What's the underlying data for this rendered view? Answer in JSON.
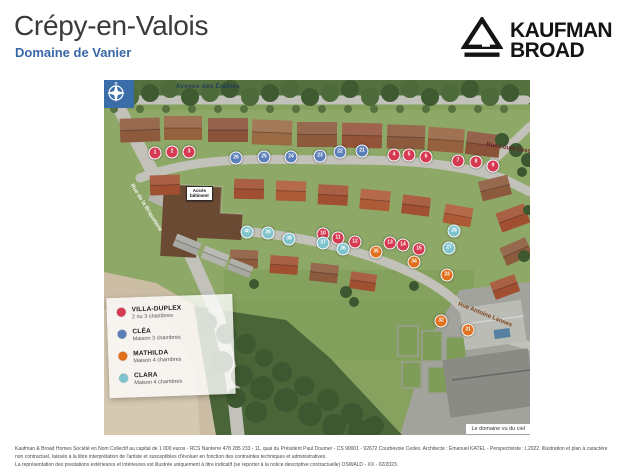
{
  "page": {
    "title": "Crépy-en-Valois",
    "subtitle": "Domaine de Vanier"
  },
  "brand": {
    "line1": "KAUFMAN",
    "line2": "BROAD"
  },
  "map": {
    "caption": "Le domaine vu du ciel",
    "access": {
      "line1": "Accès",
      "line2": "bâtiment"
    },
    "compass": {
      "n": "N"
    },
    "streets": [
      {
        "name": "Avenue des Érables"
      },
      {
        "name": "Rue Louis Cesson"
      },
      {
        "name": "Rue Antoine Lannes"
      },
      {
        "name": "Rue de la Briqueterie"
      }
    ],
    "markers": [
      {
        "n": 1,
        "type": "villa_duplex",
        "x": 51,
        "y": 73
      },
      {
        "n": 2,
        "type": "villa_duplex",
        "x": 68,
        "y": 72
      },
      {
        "n": 3,
        "type": "villa_duplex",
        "x": 85,
        "y": 72
      },
      {
        "n": 4,
        "type": "villa_duplex",
        "x": 290,
        "y": 75
      },
      {
        "n": 5,
        "type": "villa_duplex",
        "x": 305,
        "y": 75
      },
      {
        "n": 6,
        "type": "villa_duplex",
        "x": 322,
        "y": 77
      },
      {
        "n": 7,
        "type": "villa_duplex",
        "x": 354,
        "y": 81
      },
      {
        "n": 8,
        "type": "villa_duplex",
        "x": 372,
        "y": 82
      },
      {
        "n": 9,
        "type": "villa_duplex",
        "x": 389,
        "y": 86
      },
      {
        "n": 10,
        "type": "villa_duplex",
        "x": 219,
        "y": 154
      },
      {
        "n": 11,
        "type": "villa_duplex",
        "x": 234,
        "y": 158
      },
      {
        "n": 12,
        "type": "villa_duplex",
        "x": 251,
        "y": 162
      },
      {
        "n": 13,
        "type": "villa_duplex",
        "x": 286,
        "y": 163
      },
      {
        "n": 14,
        "type": "villa_duplex",
        "x": 299,
        "y": 165
      },
      {
        "n": 15,
        "type": "villa_duplex",
        "x": 315,
        "y": 169
      },
      {
        "n": 21,
        "type": "clea",
        "x": 258,
        "y": 71
      },
      {
        "n": 22,
        "type": "clea",
        "x": 236,
        "y": 72
      },
      {
        "n": 23,
        "type": "clea",
        "x": 216,
        "y": 76
      },
      {
        "n": 24,
        "type": "clea",
        "x": 187,
        "y": 77
      },
      {
        "n": 25,
        "type": "clea",
        "x": 160,
        "y": 77
      },
      {
        "n": 26,
        "type": "clea",
        "x": 132,
        "y": 78
      },
      {
        "n": 27,
        "type": "clara",
        "x": 345,
        "y": 168
      },
      {
        "n": 28,
        "type": "clara",
        "x": 350,
        "y": 151
      },
      {
        "n": 31,
        "type": "mathilda",
        "x": 364,
        "y": 250
      },
      {
        "n": 32,
        "type": "mathilda",
        "x": 337,
        "y": 241
      },
      {
        "n": 33,
        "type": "mathilda",
        "x": 343,
        "y": 195
      },
      {
        "n": 34,
        "type": "mathilda",
        "x": 310,
        "y": 182
      },
      {
        "n": 35,
        "type": "mathilda",
        "x": 272,
        "y": 172
      },
      {
        "n": 36,
        "type": "clara",
        "x": 239,
        "y": 169
      },
      {
        "n": 37,
        "type": "clara",
        "x": 219,
        "y": 163
      },
      {
        "n": 38,
        "type": "clara",
        "x": 185,
        "y": 159
      },
      {
        "n": 39,
        "type": "clara",
        "x": 164,
        "y": 153
      },
      {
        "n": 40,
        "type": "clara",
        "x": 143,
        "y": 152
      }
    ]
  },
  "legend": {
    "items": [
      {
        "key": "villa_duplex",
        "name": "VILLA-DUPLEX",
        "desc": "2 ou 3 chambres"
      },
      {
        "key": "clea",
        "name": "CLÉA",
        "desc": "Maison 3 chambres"
      },
      {
        "key": "mathilda",
        "name": "MATHILDA",
        "desc": "Maison 4 chambres"
      },
      {
        "key": "clara",
        "name": "CLARA",
        "desc": "Maison 4 chambres"
      }
    ]
  },
  "colors": {
    "villa_duplex": "#d63a52",
    "clea": "#5b7fb8",
    "mathilda": "#e0701e",
    "clara": "#7fc3cd",
    "accent": "#3a67a8"
  },
  "footer": {
    "line1": "Kaufman & Broad Homes Société en Nom Collectif au capital de 1 000 euros - RCS Nanterre 478 285 233 - 11, quai du Président Paul Doumer - CS 90001 - 92672 Courbevoie Cedex. Architecte : Emanuel KATEL - Perspectiviste : L2022. Illustration et plan à caractère non contractuel, laissés à la libre interprétation de l'artiste et susceptibles d'évoluer en fonction des contraintes techniques et administratives.",
    "line2": "La représentation des prestations extérieures et intérieures est illustrée uniquement à titre indicatif (se reporter à la notice descriptive contractuelle) OSWALD - XX - 02/2023."
  }
}
